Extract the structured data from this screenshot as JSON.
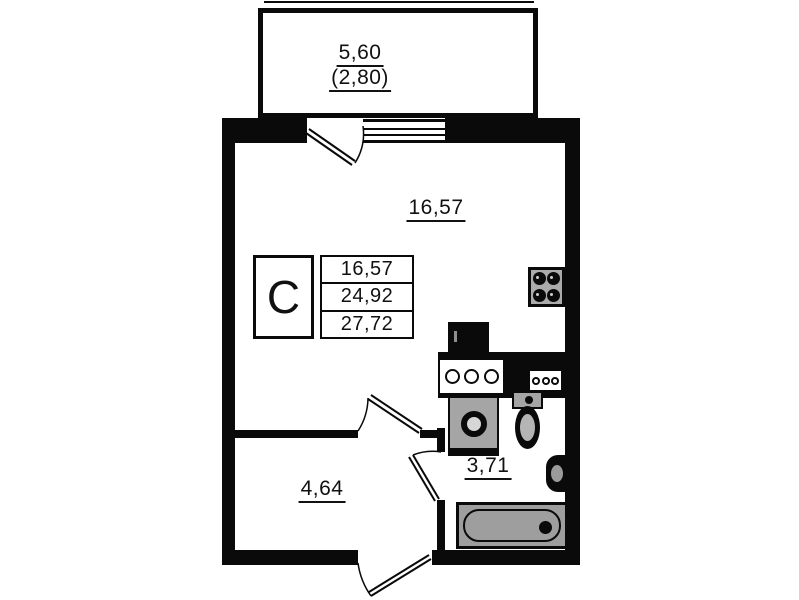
{
  "plan_labels": {
    "balcony_area": "5,60",
    "balcony_area_coefficient": "(2,80)",
    "living_room_area": "16,57",
    "hallway_area": "4,64",
    "bathroom_area": "3,71"
  },
  "legend": {
    "apartment_type": "C",
    "living_area": "16,57",
    "apartment_area": "24,92",
    "total_area": "27,72"
  },
  "colors": {
    "wall": "#0a0a0a",
    "fixture_gray": "#a5a5a5",
    "background": "#ffffff"
  }
}
